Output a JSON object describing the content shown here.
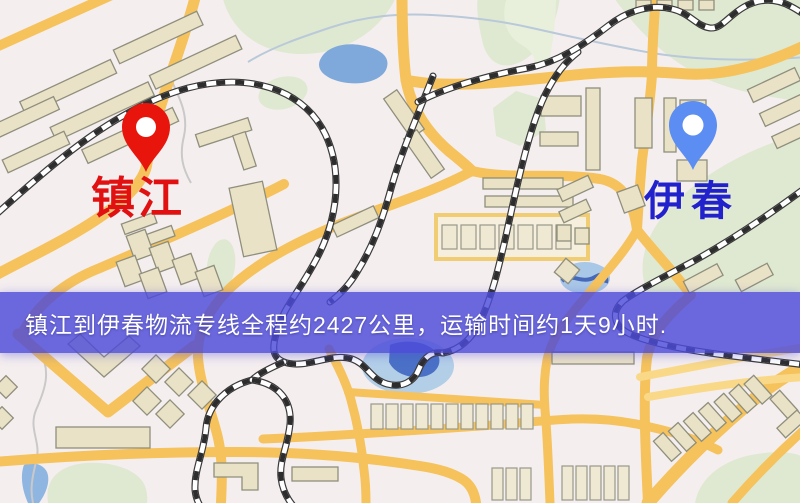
{
  "map": {
    "kind": "static-route-map",
    "markers": [
      {
        "id": "origin",
        "label": "镇江",
        "label_color": "#e11111",
        "pin_color": "#e8150d"
      },
      {
        "id": "destination",
        "label": "伊春",
        "label_color": "#2222cc",
        "pin_color": "#5b8df2"
      }
    ],
    "palette": {
      "background": "#f5eeef",
      "road": "#f5c25c",
      "building": "#eae2c6",
      "park": "#dfe9d1",
      "water": "#7fa9da",
      "railway": "#2d2d2d"
    }
  },
  "banner": {
    "text": "镇江到伊春物流专线全程约2427公里，运输时间约1天9小时.",
    "background_color": "#4d4bd9",
    "text_color": "#ffffff"
  }
}
